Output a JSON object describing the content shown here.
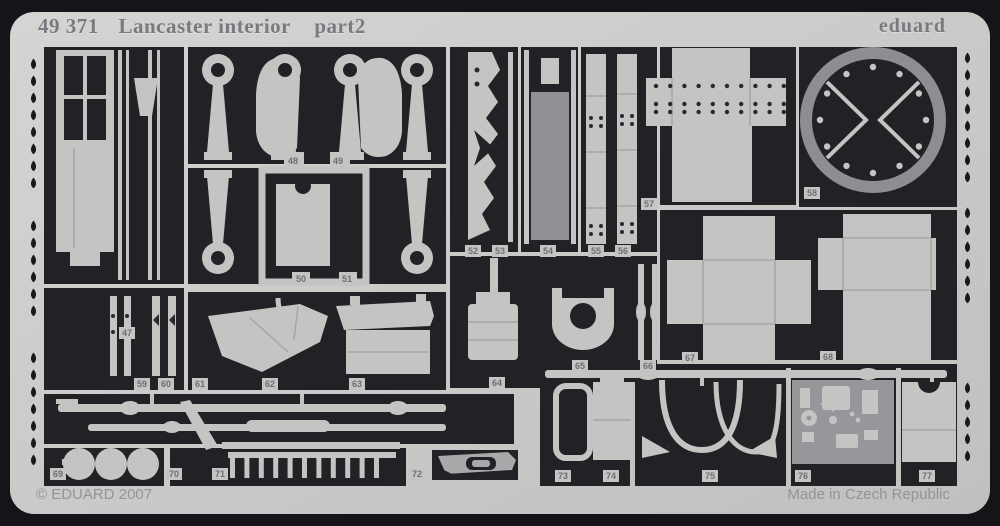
{
  "sheet": {
    "catalog_number": "49 371",
    "product_name": "Lancaster interior",
    "part_suffix": "part2",
    "brand": "eduard",
    "copyright": "© EDUARD 2007",
    "made_in": "Made in Czech Republic",
    "colors": {
      "background": "#161419",
      "sheet": "#cdcbc9",
      "cutout": "#242126",
      "part": "#c6c4c2",
      "medium": "#919094",
      "panel": "#98969b",
      "engraved": "#7b7980",
      "footer": "#95939a",
      "number": "#6f6d75"
    }
  },
  "parts": [
    {
      "num": "47",
      "x": 127,
      "y": 333
    },
    {
      "num": "48",
      "x": 293,
      "y": 161
    },
    {
      "num": "49",
      "x": 338,
      "y": 161
    },
    {
      "num": "50",
      "x": 301,
      "y": 279
    },
    {
      "num": "51",
      "x": 347,
      "y": 279
    },
    {
      "num": "52",
      "x": 473,
      "y": 251
    },
    {
      "num": "53",
      "x": 500,
      "y": 251
    },
    {
      "num": "54",
      "x": 548,
      "y": 251
    },
    {
      "num": "55",
      "x": 596,
      "y": 251
    },
    {
      "num": "56",
      "x": 623,
      "y": 251
    },
    {
      "num": "57",
      "x": 649,
      "y": 204
    },
    {
      "num": "58",
      "x": 812,
      "y": 193
    },
    {
      "num": "59",
      "x": 142,
      "y": 384
    },
    {
      "num": "60",
      "x": 166,
      "y": 384
    },
    {
      "num": "61",
      "x": 200,
      "y": 384
    },
    {
      "num": "62",
      "x": 270,
      "y": 384
    },
    {
      "num": "63",
      "x": 357,
      "y": 384
    },
    {
      "num": "64",
      "x": 497,
      "y": 383
    },
    {
      "num": "65",
      "x": 580,
      "y": 366
    },
    {
      "num": "66",
      "x": 648,
      "y": 366
    },
    {
      "num": "67",
      "x": 690,
      "y": 358
    },
    {
      "num": "68",
      "x": 828,
      "y": 357
    },
    {
      "num": "69",
      "x": 58,
      "y": 474
    },
    {
      "num": "70",
      "x": 174,
      "y": 474
    },
    {
      "num": "71",
      "x": 220,
      "y": 474
    },
    {
      "num": "72",
      "x": 417,
      "y": 474
    },
    {
      "num": "73",
      "x": 563,
      "y": 476
    },
    {
      "num": "74",
      "x": 611,
      "y": 476
    },
    {
      "num": "75",
      "x": 710,
      "y": 476
    },
    {
      "num": "76",
      "x": 803,
      "y": 476
    },
    {
      "num": "77",
      "x": 927,
      "y": 476
    }
  ]
}
